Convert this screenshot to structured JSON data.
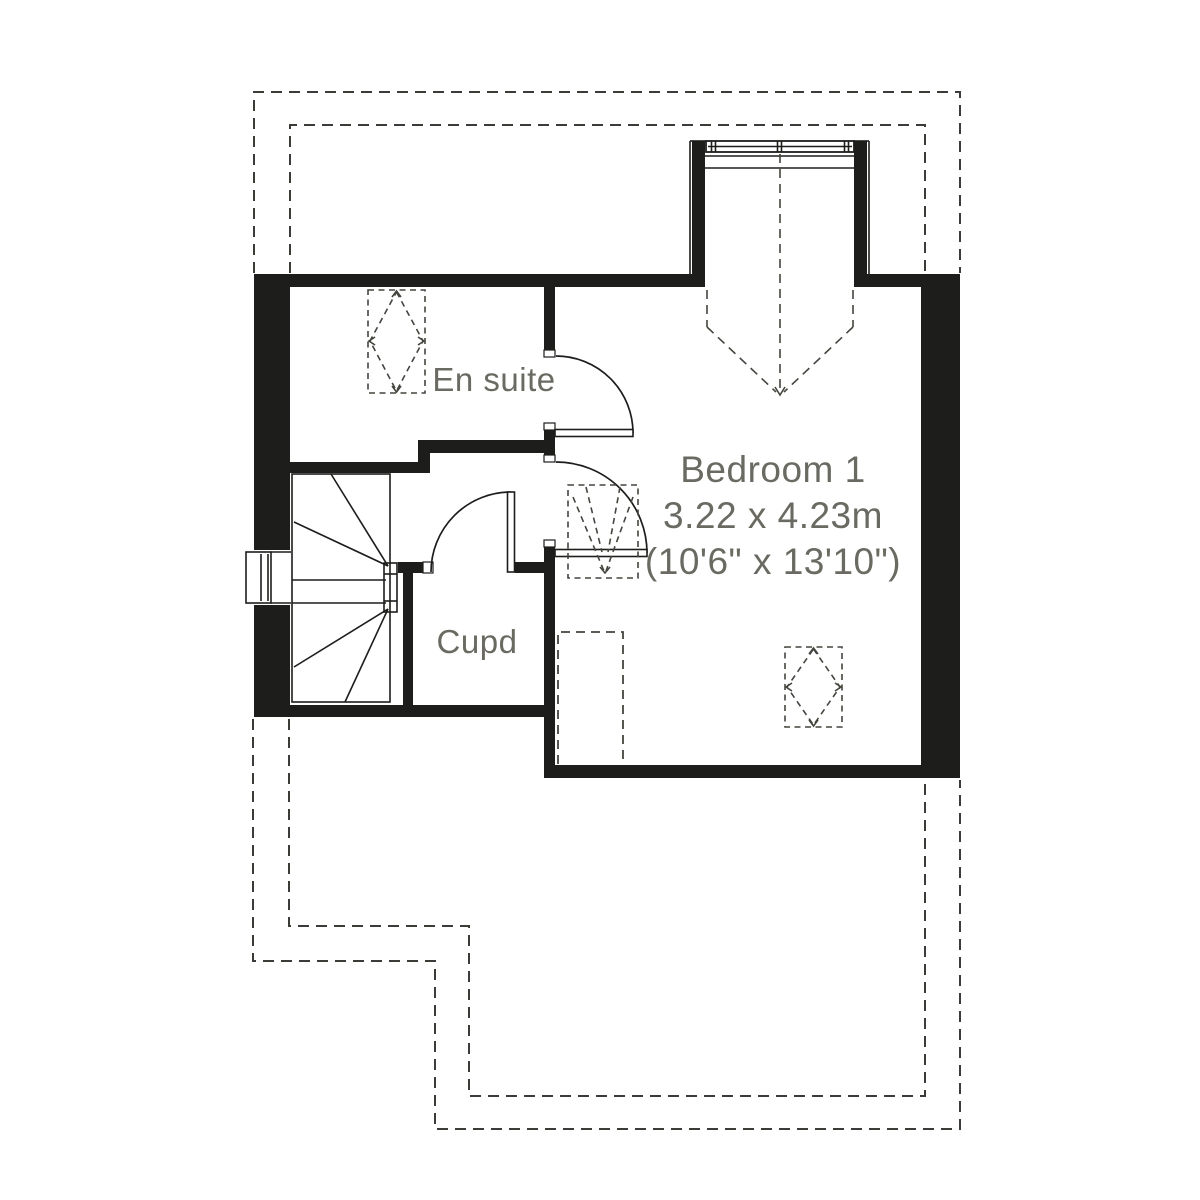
{
  "plan": {
    "rooms": {
      "en_suite": {
        "label": "En suite"
      },
      "bedroom": {
        "label": "Bedroom 1",
        "dimensions_metric": "3.22 x 4.23m",
        "dimensions_imperial": "(10'6\" x 13'10\")"
      },
      "cupboard": {
        "label": "Cupd"
      }
    },
    "colors": {
      "wall": "#1d1d1b",
      "line": "#1d1d1b",
      "dash": "#3b3b38",
      "label": "#6a6a62",
      "bg": "#ffffff"
    }
  }
}
